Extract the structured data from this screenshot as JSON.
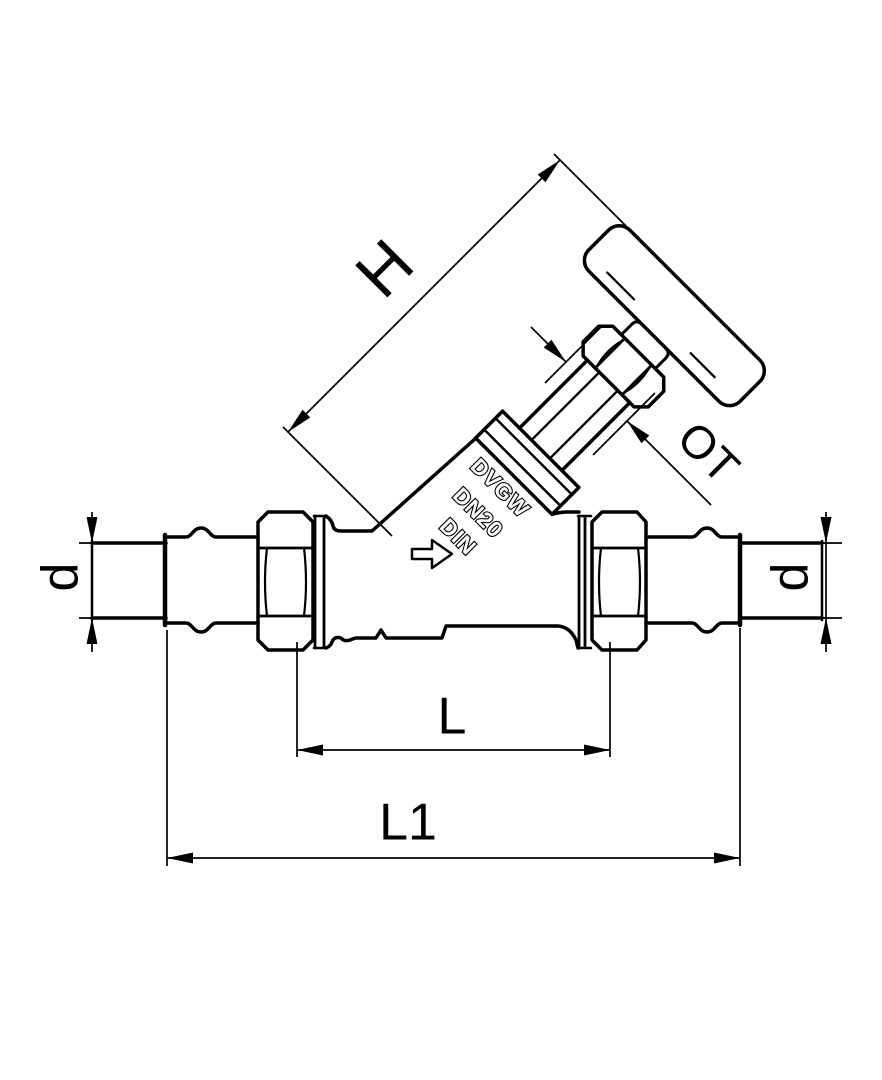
{
  "drawing": {
    "title": "Angle-seat valve with press connections - dimensional drawing",
    "colors": {
      "line": "#000000",
      "background": "#ffffff"
    },
    "dimension_labels": {
      "height": "H",
      "top_part": "OT",
      "diameter_left": "d",
      "diameter_right": "d",
      "face_to_face": "L",
      "overall_length": "L1"
    },
    "cast_markings": {
      "line1": "DVGW",
      "line2": "DN20",
      "line3": "DIN"
    },
    "icons": {
      "flow_arrow": "flow-direction-right-arrow"
    }
  }
}
